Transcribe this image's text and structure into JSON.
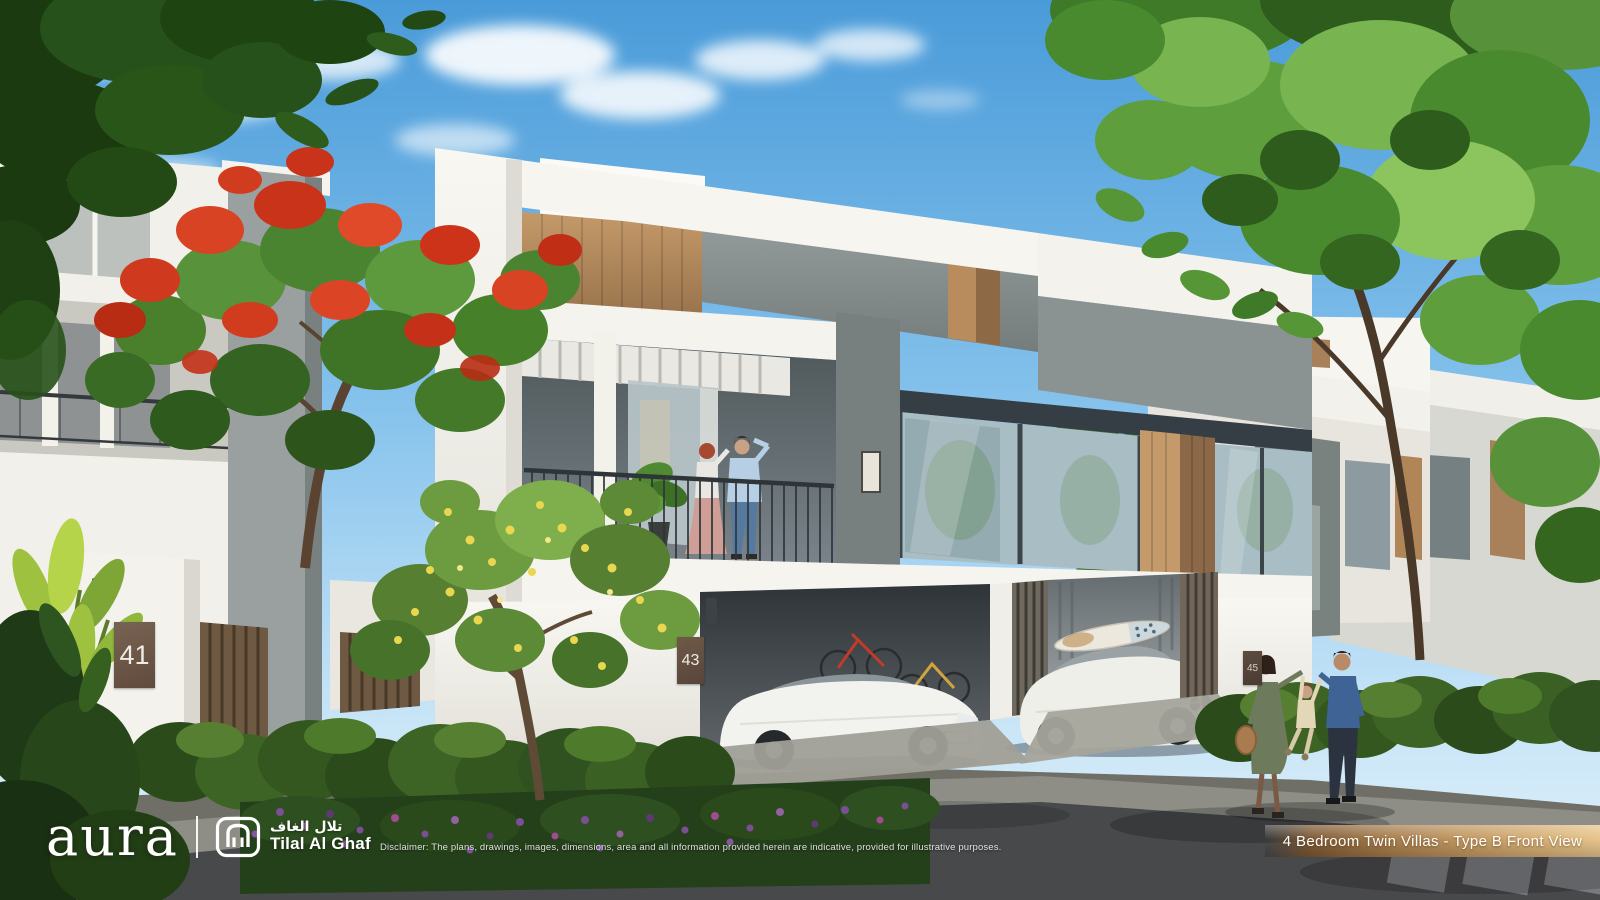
{
  "branding": {
    "aura_wordmark": "aura",
    "divider_icon": "vertical-bar",
    "estate_logo_icon": "arch-gate-icon",
    "estate_name_arabic": "تلال الغاف",
    "estate_name_english": "Tilal Al Ghaf"
  },
  "footer": {
    "disclaimer": "Disclaimer: The plans, drawings, images, dimensions, area and all information provided herein are indicative, provided for illustrative purposes."
  },
  "caption_ribbon": {
    "label": "4 Bedroom Twin Villas - Type B Front View"
  },
  "house_numbers": {
    "left_villa": "41",
    "center_villa": "43",
    "right_villa": "45"
  },
  "colors": {
    "sky_top": "#4a9bd9",
    "sky_horizon": "#dff0fb",
    "wall_white": "#f2f1ec",
    "concrete_gray": "#8b9292",
    "wood_accent": "#bb8f60",
    "foliage_green": "#4e8630",
    "foliage_dark": "#1f3d12",
    "flamboyant_red": "#d23a20",
    "blossom_yellow": "#e8d74f",
    "flower_purple": "#7b4f93",
    "asphalt": "#48494b",
    "ribbon_gold_dark": "#8a6138",
    "ribbon_gold_light": "#e2bc85",
    "plaque_brown": "#6b5244"
  },
  "scene_elements": [
    "sky",
    "clouds",
    "overhanging-foliage",
    "flamboyant-tree",
    "plumeria-tree",
    "twin-villa-facade",
    "roof-terrace-pergola",
    "balcony-couple",
    "glass-windows",
    "wood-panels",
    "carports",
    "tesla-sedan",
    "bmw-suv",
    "bicycles",
    "surfboard",
    "hedges",
    "purple-flower-bed",
    "sidewalk",
    "road",
    "family-walking"
  ]
}
